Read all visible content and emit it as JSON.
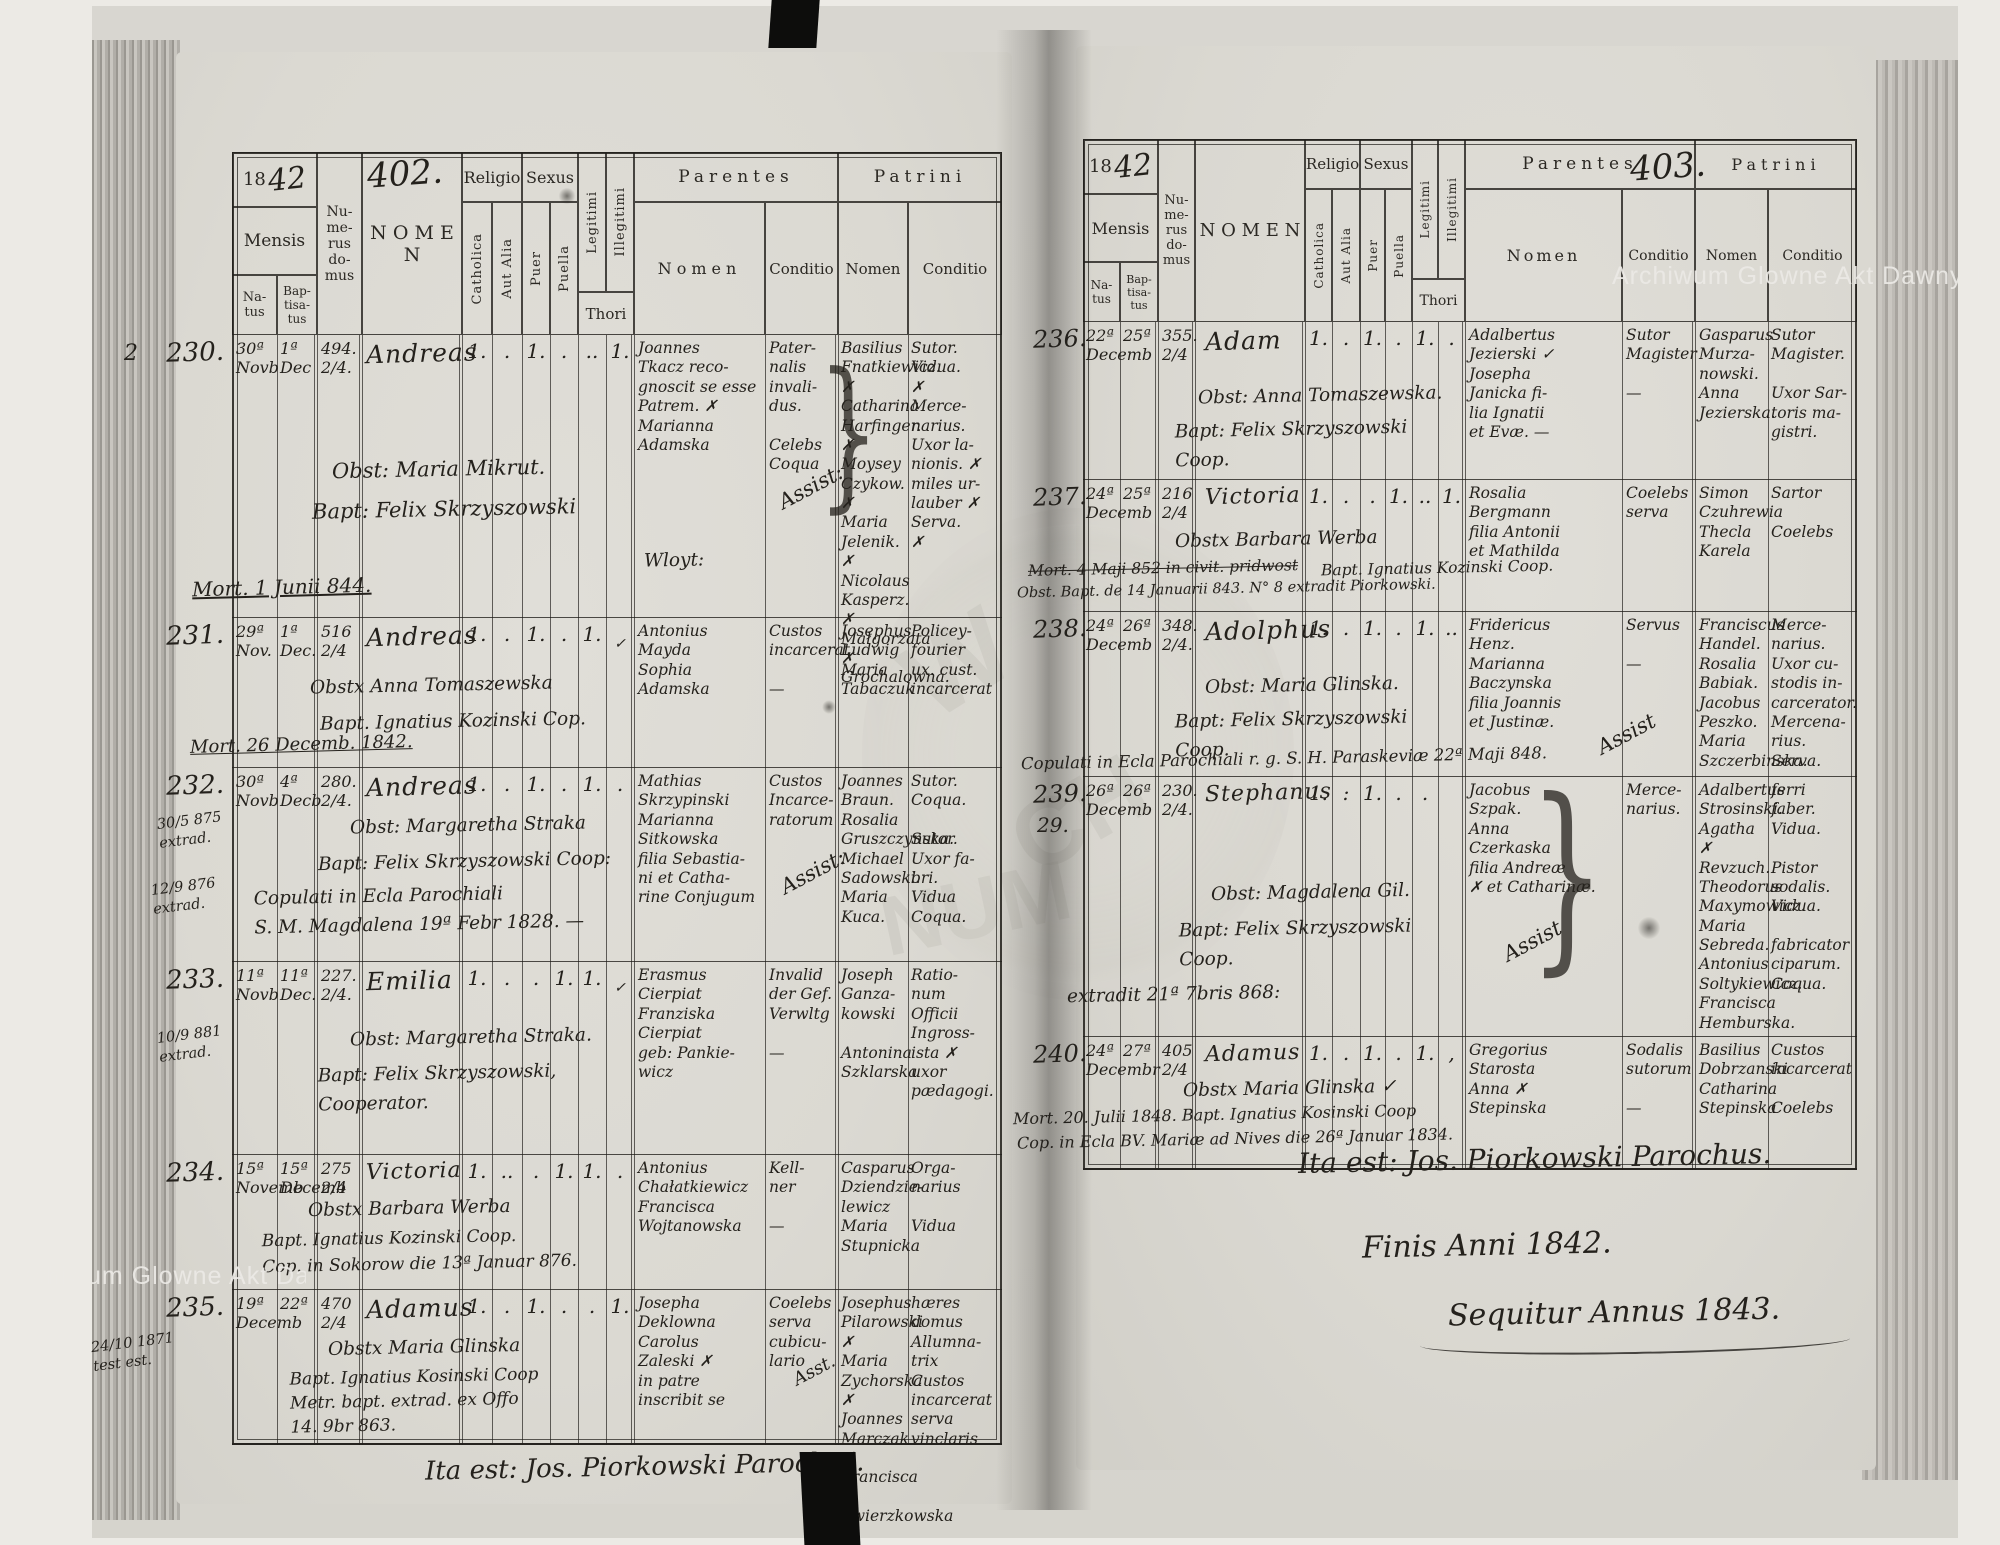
{
  "colors": {
    "ink": "#211f1a",
    "paper": "#d9d7d0",
    "watermark_text": "#eceae6"
  },
  "watermark": {
    "text": "Archiwum Glowne Akt Dawnych",
    "fragments": [
      "W",
      "CH",
      "NUM"
    ]
  },
  "misc": {
    "brace": "}"
  },
  "header_labels": {
    "year_printed": "18",
    "mensis": "Mensis",
    "natus": "Na-\ntus",
    "baptisatus": "Bap-\ntisa-\ntus",
    "numerus": "Nu-\nme-\nrus\ndo-\nmus",
    "nomen": "N O M E N",
    "religio": "Religio",
    "catholica": "Catholica",
    "aut_alia": "Aut Alia",
    "sexus": "Sexus",
    "puer": "Puer",
    "puella": "Puella",
    "legitimi": "Legitimi",
    "illegitimi": "Illegitimi",
    "thori": "Thori",
    "parentes": "Parentes",
    "patrini": "Patrini",
    "nomen_sub": "Nomen",
    "conditio": "Conditio"
  },
  "pages": [
    {
      "year_hand": "42",
      "page_no": "402.",
      "footer": "Ita est: Jos. Piorkowski Parochus.",
      "entries": [
        {
          "no": "230.",
          "margin_pre": "2",
          "natus": "30ª\nNovb",
          "bapt": "1ª\nDec",
          "domus": "494.\n2/4.",
          "nomen": "Andreas",
          "m_cath": "1.",
          "m_alia": ".",
          "m_puer": "1.",
          "m_puella": ".",
          "m_leg": "..",
          "m_ill": "1.",
          "par_nomen": "Joannes\nTkacz reco-\ngnoscit se esse\nPatrem. ✗\nMarianna\nAdamska",
          "par_cond": "Pater-\nnalis\ninvali-\ndus.\n\nCelebs\nCoqua",
          "pat_nomen": "Basilius\nFnatkiewicz. ✗\nCatharina\nHarfinger. ✗\nMoysey\nCzykow. ✗\nMaria\nJelenik. ✗\nNicolaus\nKasperz. ✗\nMałgorzata ✗\nGrochalowna.",
          "pat_cond": "Sutor.\nVidua.\n✗\nMerce-\nnarius.\nUxor la-\nnionis. ✗\nmiles ur-\nlauber ✗\nServa.\n✗",
          "note1": "Obst: Maria Mikrut.",
          "note2": "Bapt: Felix Skrzyszowski",
          "note3": "Wloyt:",
          "assist": "Assist:",
          "mort": "Mort. 1 Junii 844."
        },
        {
          "no": "231.",
          "natus": "29ª\nNov.",
          "bapt": "1ª\nDec.",
          "domus": "516\n2/4",
          "nomen": "Andreas",
          "m_cath": "1.",
          "m_alia": ".",
          "m_puer": "1.",
          "m_puella": ".",
          "m_leg": "1.",
          "m_ill": "✓",
          "par_nomen": "Antonius\nMayda\nSophia\nAdamska",
          "par_cond": "Custos\nincarcerat\n\n—",
          "pat_nomen": "Josephus\nLudwig\nMaria\nTabaczuk",
          "pat_cond": "Policey-\nfourier\nux. cust.\nincarcerat",
          "note1": "Obstx Anna Tomaszewska",
          "note2": "Bapt. Ignatius Kozinski   Cop.",
          "mort": "Mort. 26 Decemb. 1842."
        },
        {
          "no": "232.",
          "natus": "30ª\nNovb",
          "bapt": "4ª\nDecb",
          "domus": "280.\n2/4.",
          "nomen": "Andreas",
          "m_cath": "1.",
          "m_alia": ".",
          "m_puer": "1.",
          "m_puella": ".",
          "m_leg": "1.",
          "m_ill": ".",
          "par_nomen": "Mathias\nSkrzypinski\nMarianna\nSitkowska\nfilia Sebastia-\nni et Catha-\nrine Conjugum",
          "par_cond": "Custos\nIncarce-\nratorum",
          "pat_nomen": "Joannes\nBraun.\nRosalia\nGruszczynska.\nMichael\nSadowski.\nMaria\nKuca.",
          "pat_cond": "Sutor.\nCoqua.\n\nSutor.\nUxor fa-\nbri.\nVidua\nCoqua.",
          "note1": "Obst: Margaretha Straka",
          "note2": "Bapt: Felix Skrzyszowski   Coop:",
          "note3": "Copulati in Ecla Parochiali\nS. M. Magdalena 19ª Febr 1828. —",
          "assist": "Assist:",
          "margin1": "30/5 875\nextrad.",
          "margin2": "12/9 876\nextrad."
        },
        {
          "no": "233.",
          "natus": "11ª\nNovb",
          "bapt": "11ª\nDec.",
          "domus": "227.\n2/4.",
          "nomen": "Emilia",
          "m_cath": "1.",
          "m_alia": ".",
          "m_puer": ".",
          "m_puella": "1.",
          "m_leg": "1.",
          "m_ill": "✓",
          "par_nomen": "Erasmus\nCierpiat\nFranziska\nCierpiat\ngeb: Pankie-\nwicz",
          "par_cond": "Invalid\nder Gef.\nVerwltg\n\n—",
          "pat_nomen": "Joseph\nGanza-\nkowski\n\nAntonina\nSzklarska",
          "pat_cond": "Ratio-\nnum\nOfficii\nIngross-\nista ✗\nuxor\npædagogi.",
          "note1": "Obst: Margaretha Straka.",
          "note2": "Bapt: Felix Skrzyszowski,\nCooperator.",
          "margin1": "10/9 881\nextrad."
        },
        {
          "no": "234.",
          "natus": "15ª\nNovemb",
          "bapt": "15ª\nDecemb",
          "domus": "275\n2/4",
          "nomen": "Victoria",
          "m_cath": "1.",
          "m_alia": "..",
          "m_puer": ".",
          "m_puella": "1.",
          "m_leg": "1.",
          "m_ill": ".",
          "par_nomen": "Antonius\nChałatkiewicz\nFrancisca\nWojtanowska",
          "par_cond": "Kell-\nner\n\n—",
          "pat_nomen": "Casparus\nDziendzie-\nlewicz\nMaria\nStupnicka",
          "pat_cond": "Orga-\nnarius\n\nVidua",
          "note1": "Obstx Barbara Werba",
          "note2": "Bapt. Ignatius Kozinski Coop.\nCop. in Sokorow die 13ª Januar 876."
        },
        {
          "no": "235.",
          "natus": "19ª\nDecemb",
          "bapt": "22ª",
          "domus": "470\n2/4",
          "nomen": "Adamus",
          "m_cath": "1.",
          "m_alia": ".",
          "m_puer": "1.",
          "m_puella": ".",
          "m_leg": ".",
          "m_ill": "1.",
          "par_nomen": "Josepha\nDeklowna\nCarolus\nZaleski ✗\nin patre\ninscribit se",
          "par_cond": "Coelebs\nserva\ncubicu-\nlario",
          "pat_nomen": "Josephus\nPilarowski ✗\nMaria\nZychorska ✗\nJoannes\nMarczak ✗\nFrancisca ✗\nZwierzkowska",
          "pat_cond": "hæres\ndomus\nAllumna-\ntrix\nCustos\nincarcerat\nserva\nvinclaris",
          "note1": "Obstx Maria Glinska",
          "note2": "Bapt. Ignatius Kosinski Coop\nMetr. bapt. extrad. ex Offo\n14. 9br 863.",
          "assist": "Asst.",
          "margin1": "24/10 1871\ntest est."
        }
      ]
    },
    {
      "year_hand": "42",
      "page_no": "403.",
      "footer": "Ita est: Jos. Piorkowski Parochus.",
      "finis": "Finis Anni 1842.",
      "sequitur": "Sequitur Annus 1843.",
      "entries": [
        {
          "no": "236.",
          "natus": "22ª\nDecemb",
          "bapt": "25ª",
          "domus": "355.\n2/4",
          "nomen": "Adam",
          "m_cath": "1.",
          "m_alia": ".",
          "m_puer": "1.",
          "m_puella": ".",
          "m_leg": "1.",
          "m_ill": ".",
          "par_nomen": "Adalbertus\nJezierski ✓\nJosepha\nJanicka fi-\nlia Ignatii\net Evæ. —",
          "par_cond": "Sutor\nMagister\n\n—",
          "pat_nomen": "Gasparus\nMurza-\nnowski.\nAnna\nJezierska.",
          "pat_cond": "Sutor\nMagister.\n\nUxor Sar-\ntoris ma-\ngistri.",
          "note1": "Obst: Anna Tomaszewska.",
          "note2": "Bapt: Felix Skrzyszowski\nCoop."
        },
        {
          "no": "237.",
          "natus": "24ª\nDecemb",
          "bapt": "25ª",
          "domus": "216\n2/4",
          "nomen": "Victoria",
          "m_cath": "1.",
          "m_alia": ".",
          "m_puer": ".",
          "m_puella": "1.",
          "m_leg": "..",
          "m_ill": "1.",
          "par_nomen": "Rosalia\nBergmann\nfilia Antonii\net Mathilda",
          "par_cond": "Coelebs\nserva",
          "pat_nomen": "Simon\nCzuhrewia\nThecla\nKarela",
          "pat_cond": "Sartor\n\nCoelebs",
          "note1": "Obstx Barbara Werba",
          "struck": "Mort. 4 Maji 852 in civit. pridwost",
          "note2": "Bapt. Ignatius Kozinski Coop.",
          "note3": "Obst. Bapt. de 14 Januarii 843. N° 8 extradit Piorkowski."
        },
        {
          "no": "238.",
          "natus": "24ª\nDecemb",
          "bapt": "26ª",
          "domus": "348.\n2/4.",
          "nomen": "Adolphus",
          "m_cath": "1.",
          "m_alia": ".",
          "m_puer": "1.",
          "m_puella": ".",
          "m_leg": "1.",
          "m_ill": "..",
          "par_nomen": "Fridericus\nHenz.\nMarianna\nBaczynska\nfilia Joannis\net Justinæ.",
          "par_cond": "Servus\n\n—",
          "pat_nomen": "Franciscus\nHandel.\nRosalia\nBabiak.\nJacobus\nPeszko.\nMaria\nSzczerbinska.",
          "pat_cond": "Merce-\nnarius.\nUxor cu-\nstodis in-\ncarcerator.\nMercena-\nrius.\nServa.",
          "note1": "Obst: Maria Glinska.",
          "note2": "Bapt: Felix Skrzyszowski\nCoop.",
          "note3": "Copulati in Ecla Parochiali r. g. S. H. Paraskeviæ 22ª Maji 848.",
          "assist": "Assist"
        },
        {
          "no": "239.",
          "margin_pre": "29.",
          "natus": "26ª\nDecemb",
          "bapt": "26ª",
          "domus": "230.\n2/4.",
          "nomen": "Stephanus",
          "m_cath": "1.",
          "m_alia": ":",
          "m_puer": "1.",
          "m_puella": ".",
          "m_leg": ".",
          "m_ill": "",
          "par_nomen": "Jacobus\nSzpak.\nAnna\nCzerkaska\nfilia Andreæ\n✗ et Catharinæ.",
          "par_cond": "Merce-\nnarius.",
          "pat_nomen": "Adalbertus\nStrosinski.\nAgatha ✗\nRevzuch.\nTheodorus\nMaxymowicz.\nMaria\nSebreda.\nAntonius\nSoltykiewicz.\nFrancisca\nHemburska.",
          "pat_cond": "ferri\nfaber.\nVidua.\n\nPistor\nsodalis.\nVidua.\n\nfabricator\nciparum.\nCoqua.",
          "note1": "Obst: Magdalena Gil.",
          "note2": "Bapt: Felix Skrzyszowski\nCoop.",
          "note3": "extradit 21ª 7bris 868:",
          "assist": "Assist"
        },
        {
          "no": "240.",
          "natus": "24ª\nDecembr",
          "bapt": "27ª",
          "domus": "405\n2/4",
          "nomen": "Adamus",
          "m_cath": "1.",
          "m_alia": ".",
          "m_puer": "1.",
          "m_puella": ".",
          "m_leg": "1.",
          "m_ill": ",",
          "par_nomen": "Gregorius\nStarosta\nAnna ✗\nStepinska",
          "par_cond": "Sodalis\nsutorum\n\n—",
          "pat_nomen": "Basilius\nDobrzanski\nCatharina\nStepinska",
          "pat_cond": "Custos\nincarcerat\n\nCoelebs",
          "note1": "Obstx Maria Glinska ✓",
          "note2": "Mort. 20. Julii 1848. Bapt. Ignatius Kosinski Coop",
          "note3": "Cop. in Ecla BV. Mariæ ad Nives die 26ª Januar 1834."
        }
      ]
    }
  ]
}
